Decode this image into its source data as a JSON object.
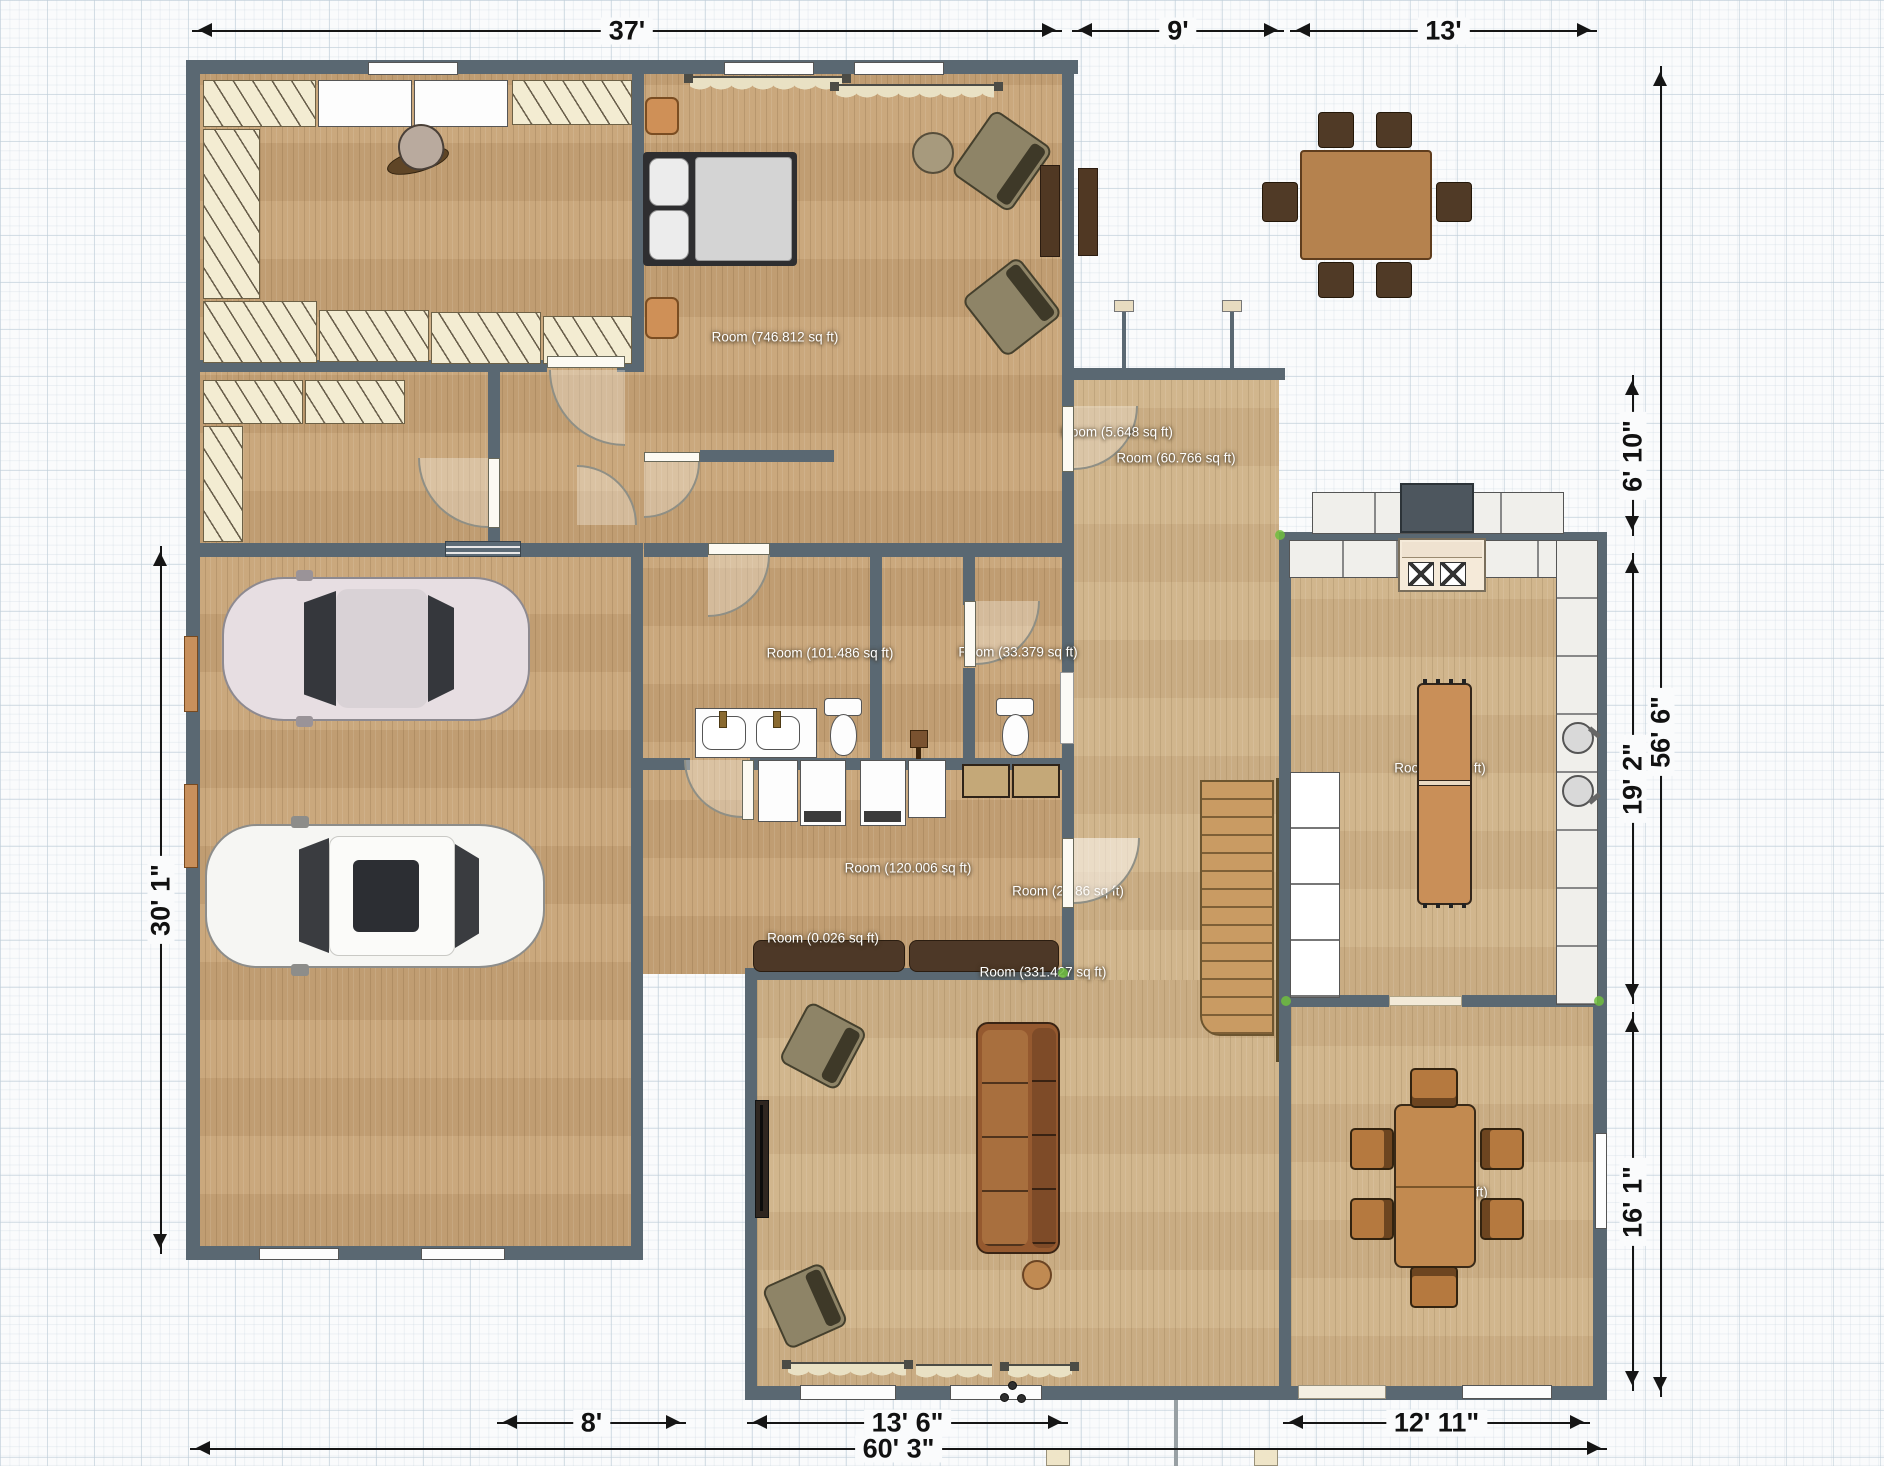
{
  "plan": {
    "room_labels": [
      {
        "label": "Room (746.812 sq ft)"
      },
      {
        "label": "Room (5.648 sq ft)"
      },
      {
        "label": "Room (60.766 sq ft)"
      },
      {
        "label": "Room (101.486 sq ft)"
      },
      {
        "label": "Room (33.379 sq ft)"
      },
      {
        "label": "Room (120.006 sq ft)"
      },
      {
        "label": "Room (29.86 sq ft)"
      },
      {
        "label": "Room (0.026 sq ft)"
      },
      {
        "label": "Room (331.427 sq ft)"
      },
      {
        "label": "Room (… sq ft)"
      },
      {
        "label": "Room (… sq ft)"
      }
    ],
    "dimensions": {
      "top": [
        "37'",
        "9'",
        "13'"
      ],
      "bottom": [
        "8'",
        "13' 6\"",
        "12' 11\"",
        "60' 3\""
      ],
      "left": [
        "30' 1\""
      ],
      "right": [
        "6' 10\"",
        "19' 2\"",
        "56' 6\"",
        "16' 1\""
      ]
    },
    "colors": {
      "wall": "#5a6872",
      "floor": "#c7a376",
      "floor_light": "#cfb287",
      "dimension_line": "#151515",
      "label_text": "#ffffff",
      "snap_accent_green": "#70be3e"
    }
  }
}
